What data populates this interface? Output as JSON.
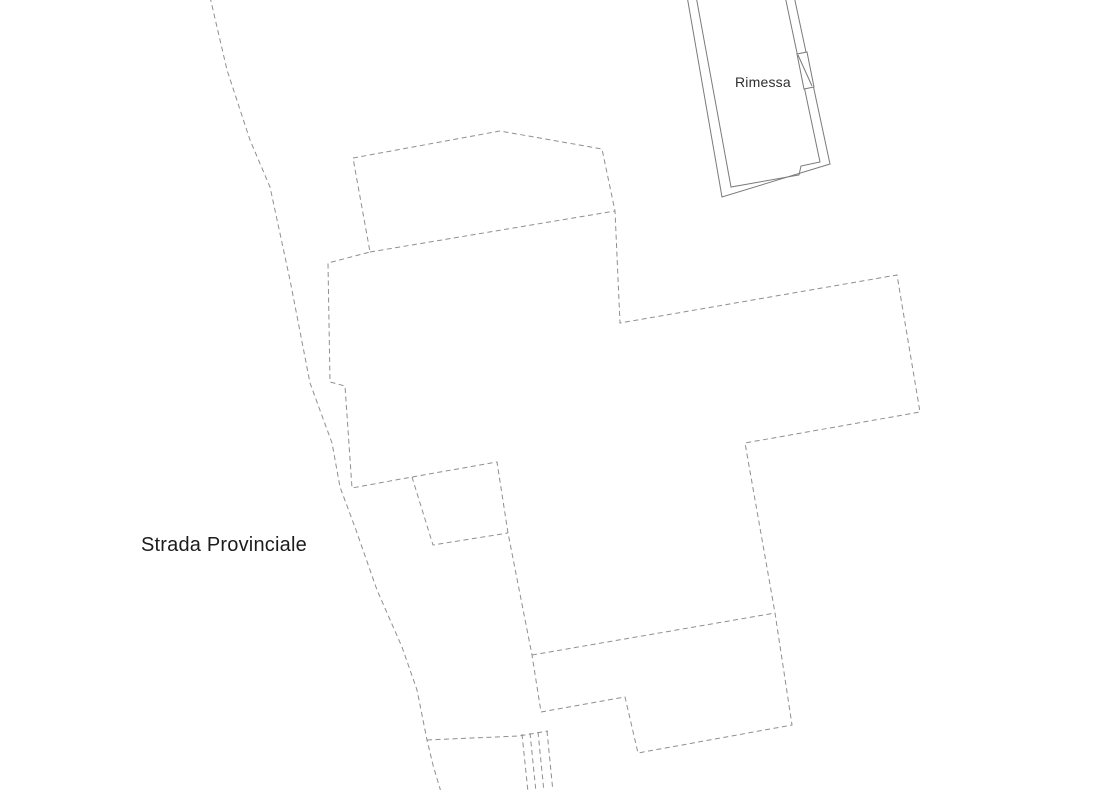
{
  "plan": {
    "building_label": "Rimessa",
    "road_label": "Strada Provinciale",
    "line_colors": {
      "dashed": "#8f8f8f",
      "solid": "#7a7a7a"
    },
    "label_colors": {
      "road": "#1c1c1c",
      "building": "#2e2e2e"
    }
  }
}
